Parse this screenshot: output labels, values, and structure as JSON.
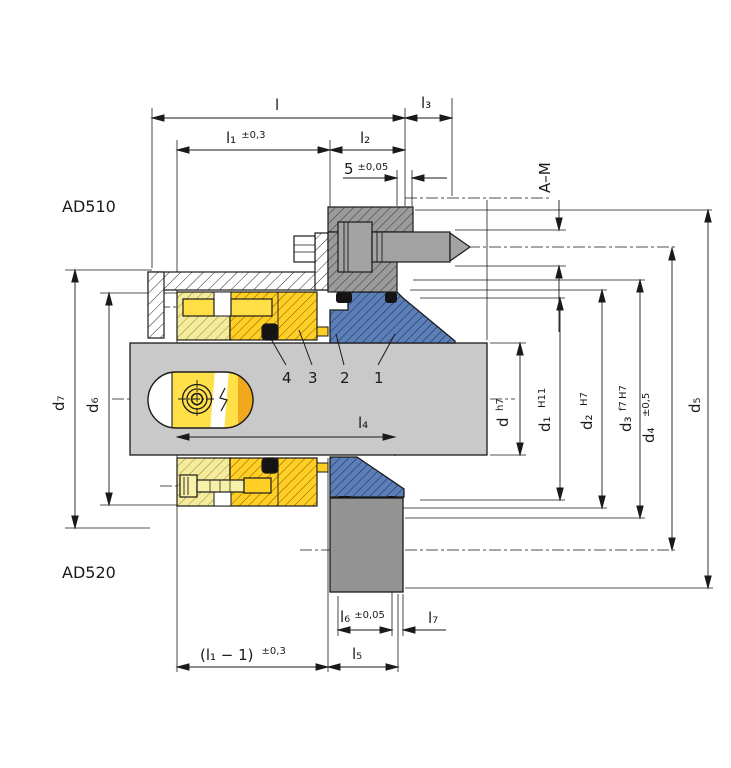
{
  "drawing": {
    "variant_top": "AD510",
    "variant_bottom": "AD520"
  },
  "dims": {
    "l": {
      "label": "l"
    },
    "l1": {
      "label": "l₁",
      "tol": "±0,3"
    },
    "l2": {
      "label": "l₂"
    },
    "l3": {
      "label": "l₃"
    },
    "l4": {
      "label": "l₄"
    },
    "l5": {
      "label": "l₅"
    },
    "l6": {
      "label": "l₆",
      "tol": "±0,05"
    },
    "l7": {
      "label": "l₇"
    },
    "gap5": {
      "label": "5",
      "tol": "±0,05"
    },
    "l1_minus_1": {
      "label": "(l₁ − 1)",
      "tol": "±0,3"
    },
    "a_m": {
      "label": "A–M"
    },
    "d": {
      "label": "d",
      "fit": "h7"
    },
    "d1": {
      "label": "d₁",
      "fit": "H11"
    },
    "d2": {
      "label": "d₂",
      "fit": "H7"
    },
    "d3": {
      "label": "d₃",
      "fit_top": "H7",
      "fit_bottom": "f7"
    },
    "d4": {
      "label": "d₄",
      "tol": "±0,5"
    },
    "d5": {
      "label": "d₅"
    },
    "d6": {
      "label": "d₆"
    },
    "d7": {
      "label": "d₇"
    }
  },
  "callouts": {
    "item1": "1",
    "item2": "2",
    "item3": "3",
    "item4": "4"
  },
  "colors": {
    "shaft_gray": "#c9c9c9",
    "pale_yellow": "#f4ec9c",
    "bright_yellow": "#ffcf26",
    "pin_yellow": "#ffdf45",
    "accent_yellow": "#f0a81c",
    "seal_blue": "#5d7fb7",
    "blue_hatch": "#1c3668",
    "clamp_gray": "#9b9b9b",
    "screw_gray": "#a3a3a3",
    "block_gray": "#939393",
    "oring_black": "#141414",
    "line": "#1a1a1a"
  }
}
